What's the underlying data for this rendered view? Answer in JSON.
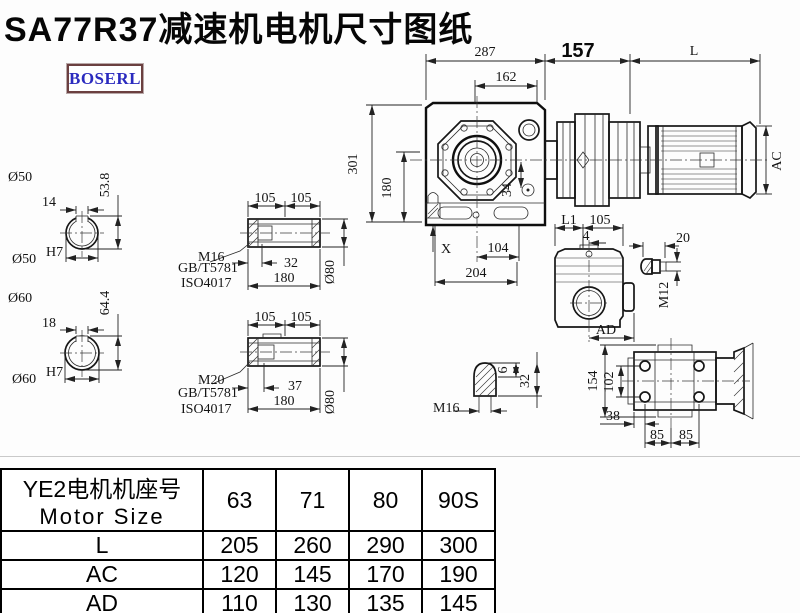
{
  "page": {
    "title": "SA77R37减速机电机尺寸图纸",
    "logo": "BOSERL"
  },
  "main_view": {
    "dim_287": "287",
    "dim_162": "162",
    "dim_157": "157",
    "dim_L": "L",
    "dim_AC": "AC",
    "dim_301": "301",
    "dim_180": "180",
    "dim_34": "34",
    "dim_X": "X",
    "dim_104": "104",
    "dim_204": "204"
  },
  "shaft_50": {
    "label": "Ø50",
    "dim_height": "53.8",
    "dim_key": "14",
    "bore": "Ø50",
    "bore_tol": "H7"
  },
  "shaft_60": {
    "label": "Ø60",
    "dim_height": "64.4",
    "dim_key": "18",
    "bore": "Ø60",
    "bore_tol": "H7"
  },
  "hollow_shaft_a": {
    "dim_l1": "105",
    "dim_l2": "105",
    "thread": "M16",
    "std_1": "GB/T5781",
    "std_2": "ISO4017",
    "dim_depth": "32",
    "dim_total": "180",
    "dim_dia": "Ø80"
  },
  "hollow_shaft_b": {
    "dim_l1": "105",
    "dim_l2": "105",
    "thread": "M20",
    "std_1": "GB/T5781",
    "std_2": "ISO4017",
    "dim_depth": "37",
    "dim_total": "180",
    "dim_dia": "Ø80"
  },
  "plug_detail": {
    "thread": "M16",
    "dim_tip": "6",
    "dim_len": "32"
  },
  "side_view": {
    "dim_l1": "L1",
    "dim_105": "105",
    "dim_4": "4",
    "dim_ad": "AD"
  },
  "bolt_detail": {
    "dim_len": "20",
    "thread": "M12"
  },
  "rear_view": {
    "dim_height": "154",
    "dim_bolt_v": "102",
    "dim_38": "38",
    "dim_85a": "85",
    "dim_85b": "85"
  },
  "table": {
    "header_line1": "YE2电机机座号",
    "header_line2": "Motor Size",
    "sizes": [
      "63",
      "71",
      "80",
      "90S"
    ],
    "rows": [
      {
        "label": "L",
        "values": [
          "205",
          "260",
          "290",
          "300"
        ]
      },
      {
        "label": "AC",
        "values": [
          "120",
          "145",
          "170",
          "190"
        ]
      },
      {
        "label": "AD",
        "values": [
          "110",
          "130",
          "135",
          "145"
        ]
      }
    ]
  }
}
